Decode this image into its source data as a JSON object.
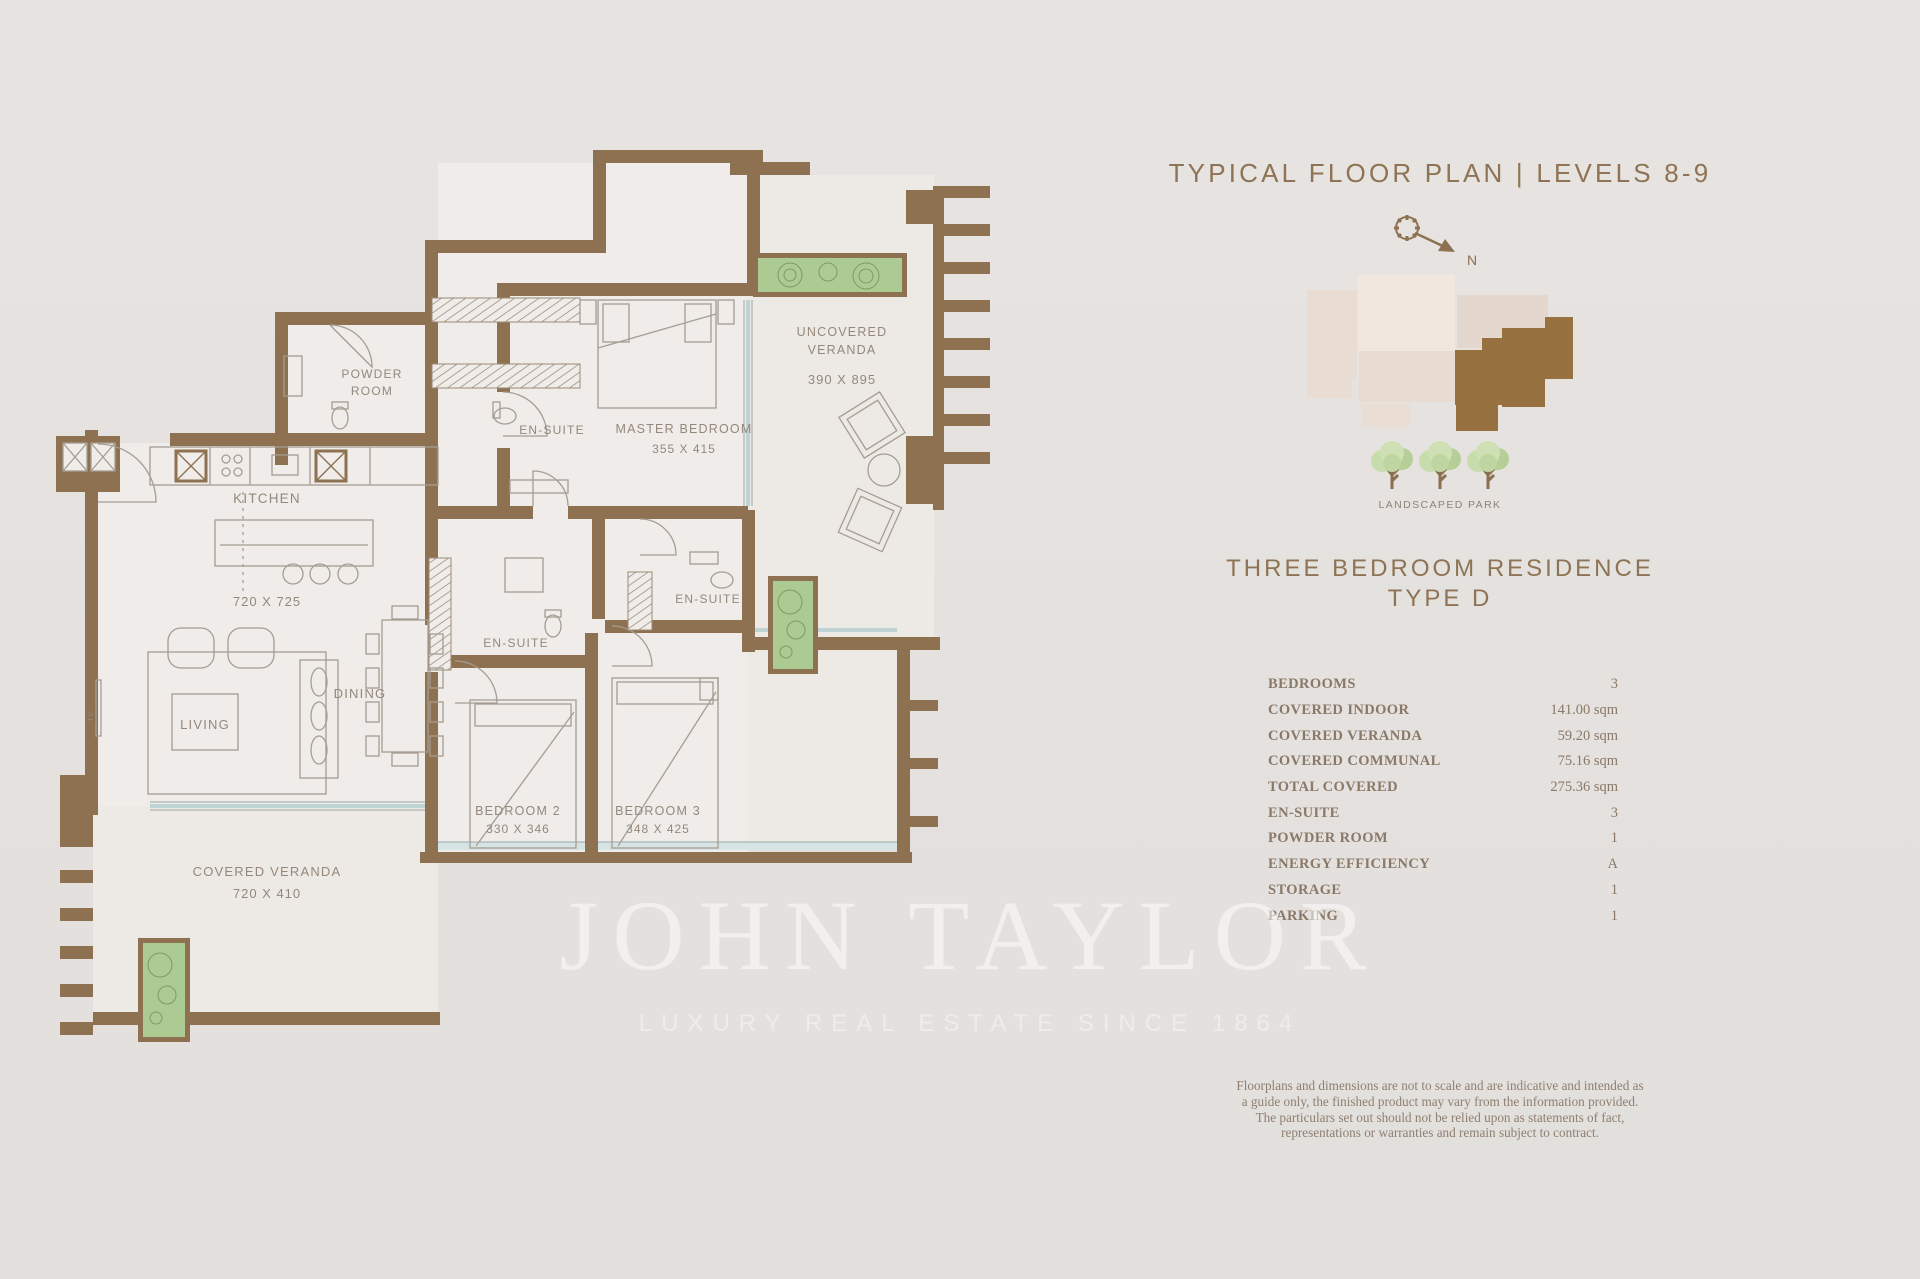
{
  "header": {
    "title": "TYPICAL FLOOR PLAN | LEVELS 8-9"
  },
  "site_map": {
    "north_label": "N",
    "park_label": "LANDSCAPED PARK",
    "highlight_color": "#97713f",
    "building_color": "#f0e5dc"
  },
  "residence": {
    "heading_line1": "THREE BEDROOM RESIDENCE",
    "heading_line2": "TYPE D"
  },
  "specs": {
    "rows": [
      {
        "label": "BEDROOMS",
        "value": "3"
      },
      {
        "label": "COVERED INDOOR",
        "value": "141.00 sqm"
      },
      {
        "label": "COVERED VERANDA",
        "value": "59.20 sqm"
      },
      {
        "label": "COVERED COMMUNAL",
        "value": "75.16 sqm"
      },
      {
        "label": "TOTAL COVERED",
        "value": "275.36 sqm"
      },
      {
        "label": "EN-SUITE",
        "value": "3"
      },
      {
        "label": "POWDER ROOM",
        "value": "1"
      },
      {
        "label": "ENERGY EFFICIENCY",
        "value": "A"
      },
      {
        "label": "STORAGE",
        "value": "1"
      },
      {
        "label": "PARKING",
        "value": "1"
      }
    ]
  },
  "disclaimer": {
    "text": "Floorplans and dimensions are not to scale and are indicative and intended as a guide only, the finished product may vary from the information provided. The particulars set out should not be relied upon as statements of fact, representations or warranties and remain subject to contract."
  },
  "watermark": {
    "line1": "JOHN TAYLOR",
    "line2": "LUXURY REAL ESTATE SINCE 1864"
  },
  "floor_plan": {
    "wall_color": "#8d7150",
    "labels": {
      "powder_line1": "POWDER",
      "powder_line2": "ROOM",
      "kitchen": "KITCHEN",
      "kitchen_dim": "720 X 725",
      "living": "LIVING",
      "dining": "DINING",
      "tv": "TV",
      "master": "MASTER BEDROOM",
      "master_dim": "355 X 415",
      "ensuite_master": "EN-SUITE",
      "ensuite_bed2": "EN-SUITE",
      "ensuite_bed3": "EN-SUITE",
      "uncovered_line1": "UNCOVERED",
      "uncovered_line2": "VERANDA",
      "uncovered_dim": "390 X 895",
      "bedroom2": "BEDROOM 2",
      "bedroom2_dim": "330 X 346",
      "bedroom3": "BEDROOM 3",
      "bedroom3_dim": "348 X 425",
      "covered": "COVERED VERANDA",
      "covered_dim": "720 X 410"
    }
  }
}
